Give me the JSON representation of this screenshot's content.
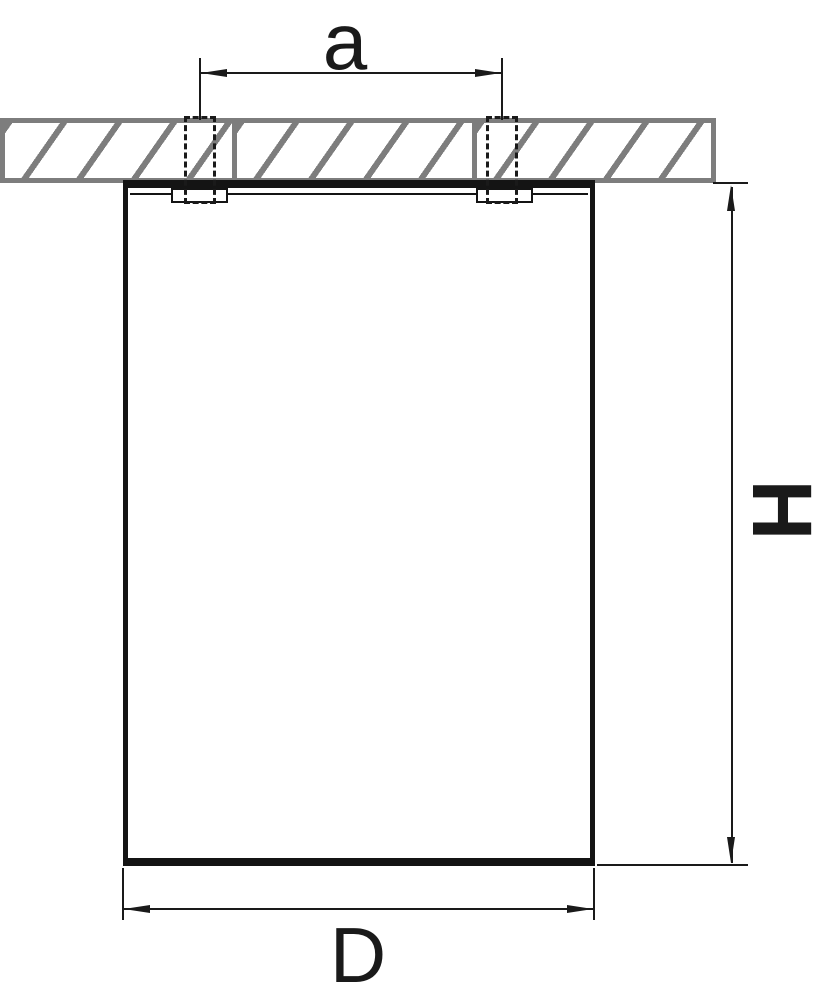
{
  "dimensions": {
    "spacing_label": "a",
    "height_label": "H",
    "diameter_label": "D"
  },
  "colors": {
    "line": "#1a1a1a",
    "ceiling_gray": "#7d7d7d",
    "background": "#ffffff"
  }
}
